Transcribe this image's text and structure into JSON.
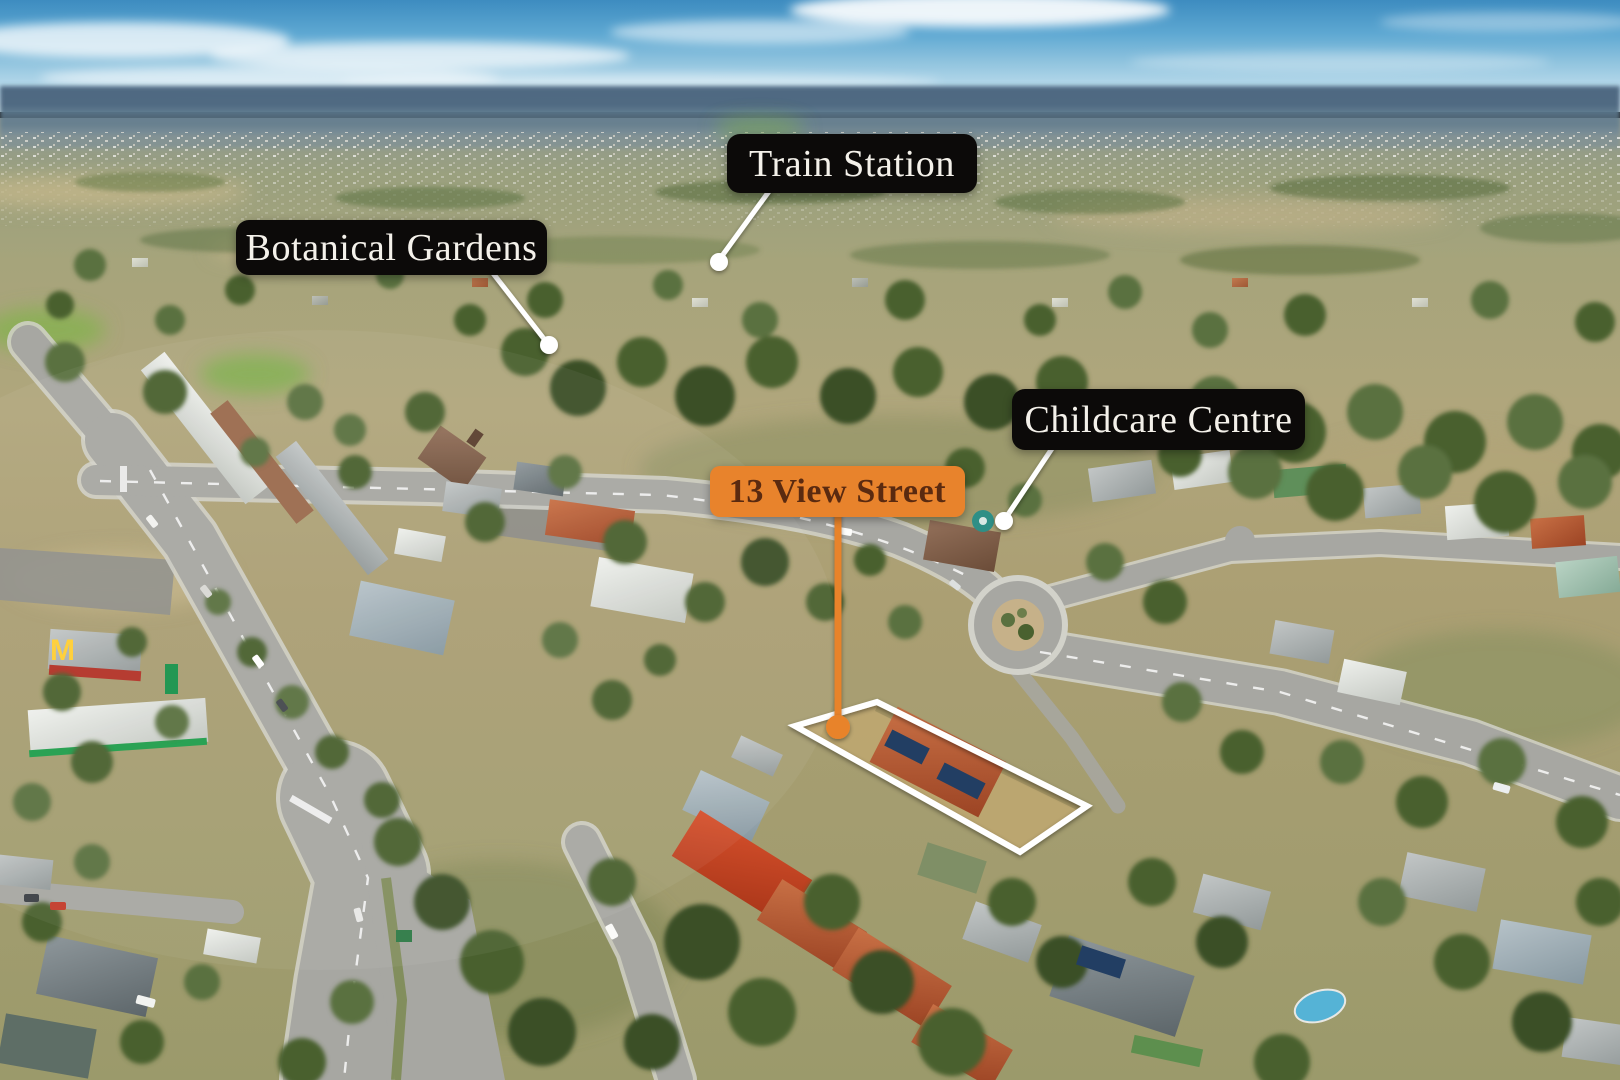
{
  "annotations": {
    "train_station_label": "Train Station",
    "botanical_gardens_label": "Botanical Gardens",
    "childcare_centre_label": "Childcare Centre",
    "address_label": "13 View Street"
  },
  "icons": {
    "mcdonalds_logo_glyph": "M"
  },
  "colors": {
    "label-bg": "#0c0a09",
    "label-text": "#f4f1ea",
    "accent": "#e8832c",
    "accent-text": "#5a2a10",
    "outline-white": "#ffffff"
  }
}
